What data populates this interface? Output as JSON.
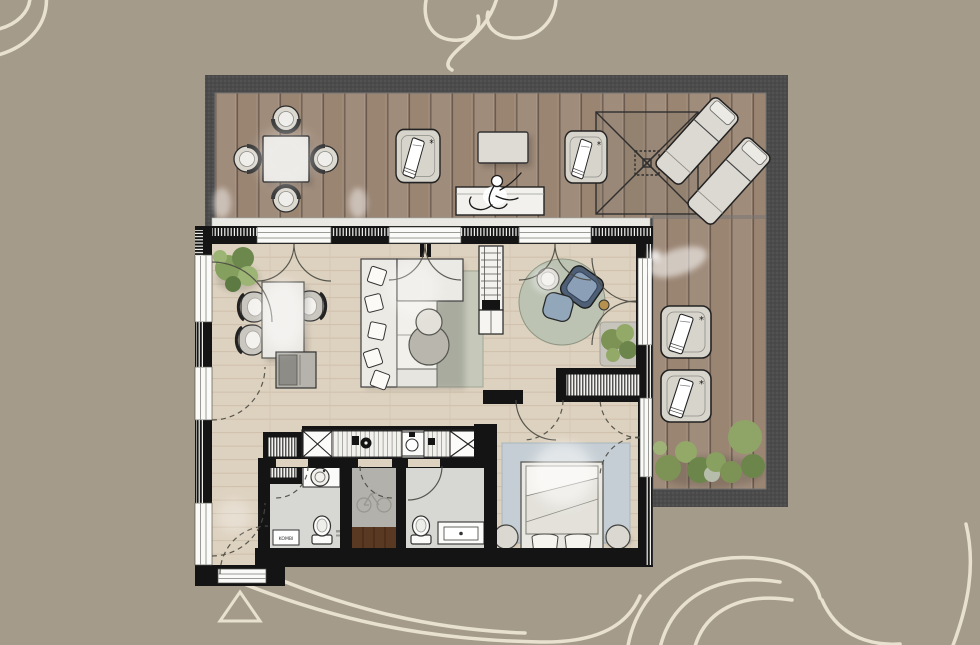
{
  "canvas": {
    "width": 980,
    "height": 645
  },
  "labels": {
    "washer_unit": "KOMBI"
  },
  "palette": {
    "background": "#a49b8a",
    "watermark": "#f1e9d8",
    "deck_border": "#4b4b4b",
    "deck_wood": "#9a8573",
    "deck_plank_line": "#6b5a4e",
    "wall": "#141414",
    "window": "#fafaf8",
    "wood_floor": "#ddd1bf",
    "tile_floor": "#d7d7d3",
    "storage_floor": "#b2b1ab",
    "entry_mat_brown": "#5a3922",
    "sofa_rug": "#c6c9ba",
    "round_rug": "#bcc3b3",
    "bedroom_rug": "#c5ced4",
    "armchair_shell": "#4f6076",
    "armchair_cushion": "#8ba0b6",
    "plant_green": "#7d9355",
    "accent_gold": "#b5904e"
  },
  "terrace": {
    "furniture": [
      "outdoor-dining-table",
      "outdoor-chairs-4",
      "lounge-chair-with-towel-1",
      "side-table",
      "bench-with-person",
      "lounge-chair-with-towel-2",
      "pergola-parasol",
      "sun-lounger-1",
      "sun-lounger-2",
      "lounge-chair-with-towel-3",
      "lounge-chair-with-towel-4",
      "shrubs"
    ]
  },
  "apartment": {
    "rooms": [
      "living-dining-room",
      "open-kitchen",
      "corridor",
      "bathroom-laundry",
      "storage-room",
      "bathroom-2",
      "bedroom"
    ],
    "furniture": [
      "indoor-plant-1",
      "dining-table",
      "dining-chairs-3",
      "sideboard",
      "l-shaped-sofa",
      "sofa-rug",
      "coffee-table",
      "shelf-unit",
      "round-rug",
      "side-table-round",
      "armchair",
      "ottoman",
      "indoor-plant-2",
      "tall-cabinet-left",
      "kitchen-counter",
      "cooktop",
      "kitchen-sink",
      "tall-cabinet-right",
      "storage-cabinet",
      "washing-machine",
      "toilet-1",
      "washer-dryer-combi",
      "bicycle",
      "entry-mat",
      "toilet-2",
      "vanity",
      "wardrobe",
      "bedroom-rug",
      "double-bed",
      "pillows",
      "nightstand-1",
      "nightstand-2"
    ]
  }
}
